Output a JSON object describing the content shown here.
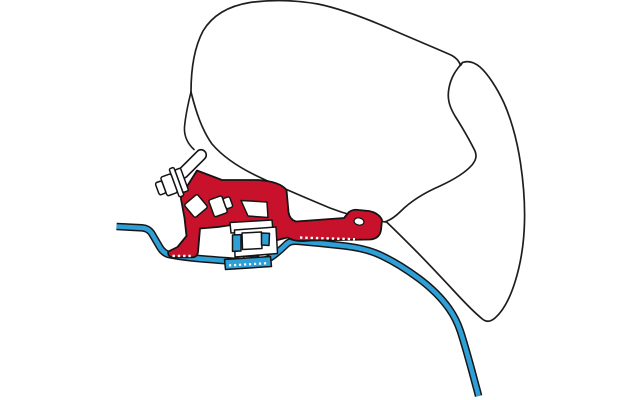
{
  "diagram": {
    "subject": "awning-adapter-bracket-cross-section",
    "colors": {
      "background": "#ffffff",
      "outline": "#1e1e1c",
      "adapter_red": "#c8112b",
      "roof_blue": "#2f9fd7",
      "line_casing": "#161616",
      "hardware_stroke": "#1a1a1a",
      "serration_white": "#ffffff"
    },
    "components": {
      "awning_case": "awning-case-profile",
      "front_flap": "awning-case-front-flap",
      "lead_bar": "lead-bar-blade",
      "adapter_bracket": "red-adapter-bracket",
      "roof_profile": "vehicle-roof-profile-line",
      "rail_clamp": "roof-rail-clamp",
      "fasteners": "mounting-bolts-and-nut",
      "mounting_hole": "slot-hole"
    }
  }
}
